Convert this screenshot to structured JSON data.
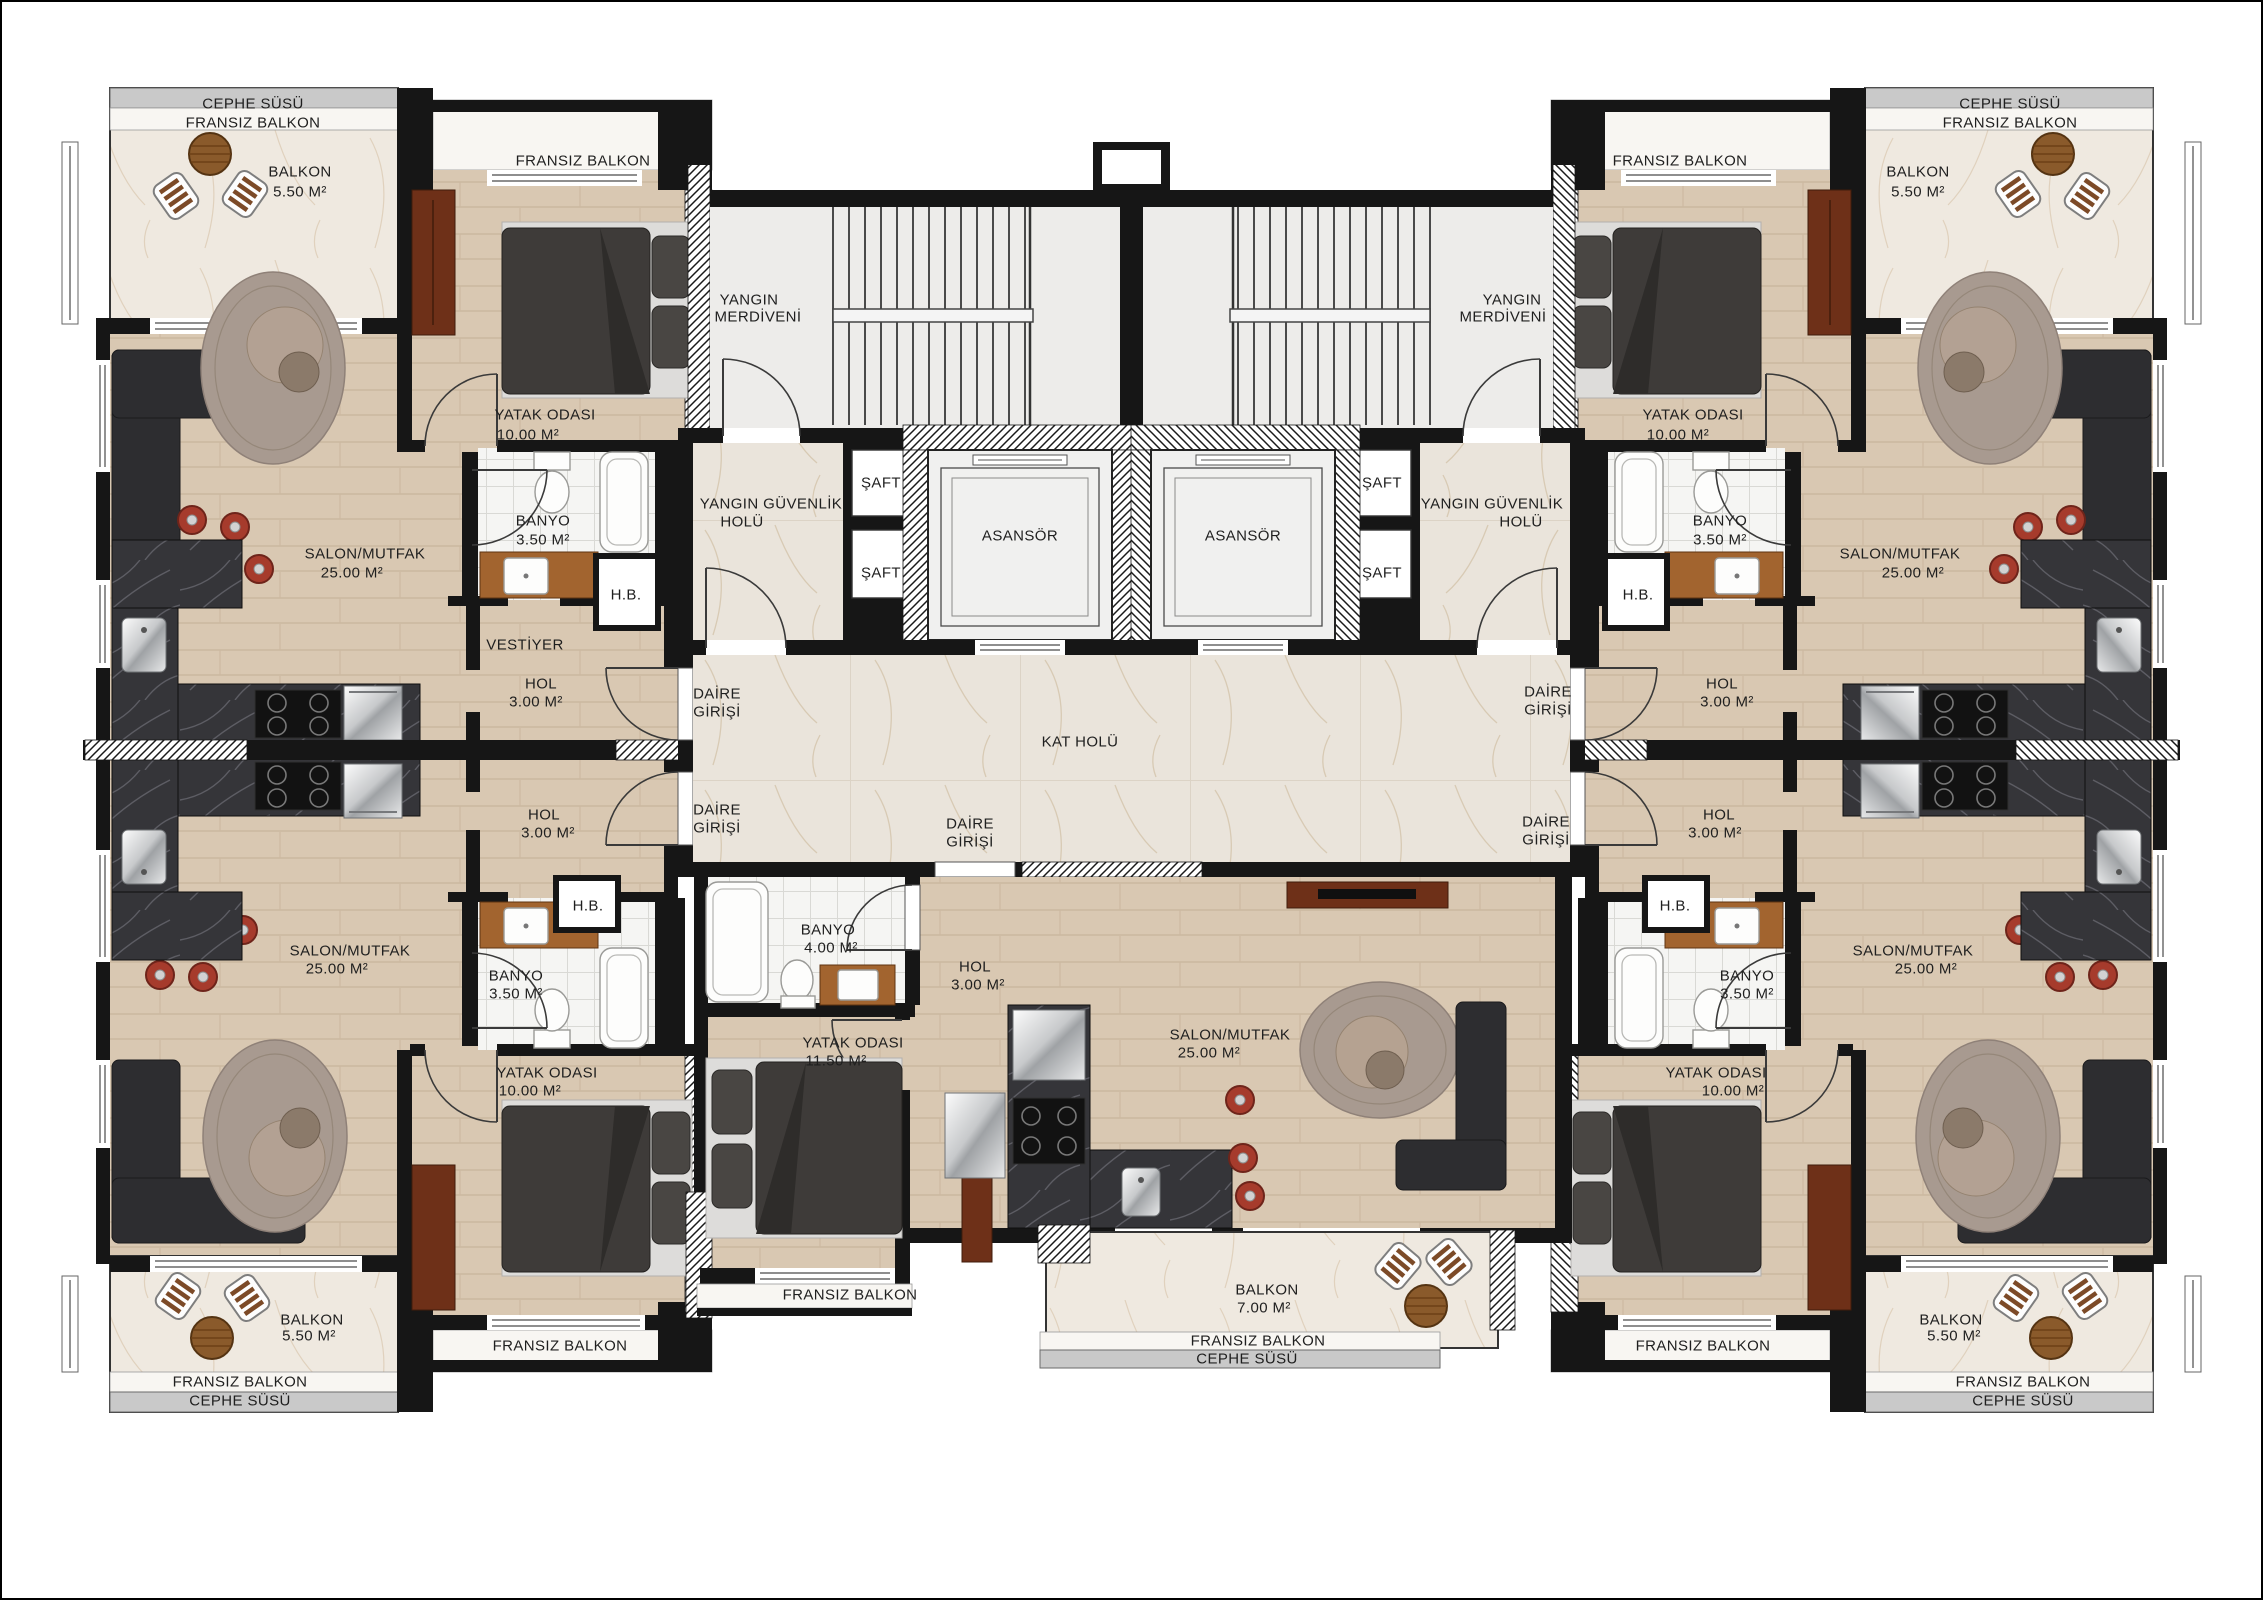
{
  "doc": {
    "type": "architectural-floor-plan",
    "language": "Turkish"
  },
  "colors": {
    "wall": "#161616",
    "wood_floor": "#d9c8b2",
    "corridor_marble": "#eae4db",
    "balcony_marble": "#efe9e0",
    "tile": "#f5f5f3",
    "counter_dark_marble": "#353539",
    "facade_band": "#c9c9c9",
    "sofa": "#2d2d30",
    "bed": "#3e3b39",
    "furniture_wood": "#6e3018",
    "stool_red": "#a63b2c",
    "steel": "#c7c9cb"
  },
  "labels": [
    {
      "id": "cephe-tl",
      "text": "CEPHE SÜSÜ",
      "x": 253,
      "y": 104
    },
    {
      "id": "fransiz-tl",
      "text": "FRANSIZ BALKON",
      "x": 253,
      "y": 123
    },
    {
      "id": "balkon-tl",
      "text": "BALKON",
      "x": 300,
      "y": 172
    },
    {
      "id": "balkon-tl-area",
      "text": "5.50 M²",
      "x": 300,
      "y": 192
    },
    {
      "id": "fransiz-tl-bed",
      "text": "FRANSIZ BALKON",
      "x": 583,
      "y": 161
    },
    {
      "id": "yatak-tl",
      "text": "YATAK ODASI",
      "x": 545,
      "y": 415
    },
    {
      "id": "yatak-tl-area",
      "text": "10.00 M²",
      "x": 528,
      "y": 435
    },
    {
      "id": "banyo-tl",
      "text": "BANYO",
      "x": 543,
      "y": 521
    },
    {
      "id": "banyo-tl-area",
      "text": "3.50 M²",
      "x": 543,
      "y": 540
    },
    {
      "id": "hb-tl",
      "text": "H.B.",
      "x": 626,
      "y": 595
    },
    {
      "id": "vestiyer-tl",
      "text": "VESTİYER",
      "x": 525,
      "y": 645
    },
    {
      "id": "hol-tl",
      "text": "HOL",
      "x": 541,
      "y": 684
    },
    {
      "id": "hol-tl-area",
      "text": "3.00 M²",
      "x": 536,
      "y": 702
    },
    {
      "id": "salon-tl",
      "text": "SALON/MUTFAK",
      "x": 365,
      "y": 554
    },
    {
      "id": "salon-tl-area",
      "text": "25.00 M²",
      "x": 352,
      "y": 573
    },
    {
      "id": "yangin-l1",
      "text": "YANGIN",
      "x": 749,
      "y": 300
    },
    {
      "id": "yangin-l2",
      "text": "MERDİVENİ",
      "x": 758,
      "y": 317
    },
    {
      "id": "yangin-r1",
      "text": "YANGIN",
      "x": 1512,
      "y": 300
    },
    {
      "id": "yangin-r2",
      "text": "MERDİVENİ",
      "x": 1503,
      "y": 317
    },
    {
      "id": "guvenlik-l1",
      "text": "YANGIN GÜVENLİK",
      "x": 771,
      "y": 504
    },
    {
      "id": "guvenlik-l2",
      "text": "HOLÜ",
      "x": 742,
      "y": 522
    },
    {
      "id": "guvenlik-r1",
      "text": "YANGIN GÜVENLİK",
      "x": 1492,
      "y": 504
    },
    {
      "id": "guvenlik-r2",
      "text": "HOLÜ",
      "x": 1521,
      "y": 522
    },
    {
      "id": "saft-l1",
      "text": "ŞAFT",
      "x": 881,
      "y": 483
    },
    {
      "id": "saft-l2",
      "text": "ŞAFT",
      "x": 881,
      "y": 573
    },
    {
      "id": "saft-r1",
      "text": "ŞAFT",
      "x": 1382,
      "y": 483
    },
    {
      "id": "saft-r2",
      "text": "ŞAFT",
      "x": 1382,
      "y": 573
    },
    {
      "id": "asansor-l",
      "text": "ASANSÖR",
      "x": 1020,
      "y": 536
    },
    {
      "id": "asansor-r",
      "text": "ASANSÖR",
      "x": 1243,
      "y": 536
    },
    {
      "id": "kat-holu",
      "text": "KAT HOLÜ",
      "x": 1080,
      "y": 742
    },
    {
      "id": "daire-l1a",
      "text": "DAİRE",
      "x": 717,
      "y": 694
    },
    {
      "id": "daire-l1b",
      "text": "GİRİŞİ",
      "x": 717,
      "y": 712
    },
    {
      "id": "daire-l2a",
      "text": "DAİRE",
      "x": 717,
      "y": 810
    },
    {
      "id": "daire-l2b",
      "text": "GİRİŞİ",
      "x": 717,
      "y": 828
    },
    {
      "id": "daire-ca",
      "text": "DAİRE",
      "x": 970,
      "y": 824
    },
    {
      "id": "daire-cb",
      "text": "GİRİŞİ",
      "x": 970,
      "y": 842
    },
    {
      "id": "daire-r1a",
      "text": "DAİRE",
      "x": 1548,
      "y": 692
    },
    {
      "id": "daire-r1b",
      "text": "GİRİŞİ",
      "x": 1548,
      "y": 710
    },
    {
      "id": "daire-r2a",
      "text": "DAİRE",
      "x": 1546,
      "y": 822
    },
    {
      "id": "daire-r2b",
      "text": "GİRİŞİ",
      "x": 1546,
      "y": 840
    },
    {
      "id": "yatak-tr",
      "text": "YATAK ODASI",
      "x": 1693,
      "y": 415
    },
    {
      "id": "yatak-tr-area",
      "text": "10.00 M²",
      "x": 1678,
      "y": 435
    },
    {
      "id": "fransiz-tr-bed",
      "text": "FRANSIZ BALKON",
      "x": 1680,
      "y": 161
    },
    {
      "id": "cephe-tr",
      "text": "CEPHE SÜSÜ",
      "x": 2010,
      "y": 104
    },
    {
      "id": "fransiz-tr",
      "text": "FRANSIZ BALKON",
      "x": 2010,
      "y": 123
    },
    {
      "id": "balkon-tr",
      "text": "BALKON",
      "x": 1918,
      "y": 172
    },
    {
      "id": "balkon-tr-area",
      "text": "5.50 M²",
      "x": 1918,
      "y": 192
    },
    {
      "id": "banyo-tr",
      "text": "BANYO",
      "x": 1720,
      "y": 521
    },
    {
      "id": "banyo-tr-area",
      "text": "3.50 M²",
      "x": 1720,
      "y": 540
    },
    {
      "id": "hb-tr",
      "text": "H.B.",
      "x": 1638,
      "y": 595
    },
    {
      "id": "hol-tr",
      "text": "HOL",
      "x": 1722,
      "y": 684
    },
    {
      "id": "hol-tr-area",
      "text": "3.00 M²",
      "x": 1727,
      "y": 702
    },
    {
      "id": "salon-tr",
      "text": "SALON/MUTFAK",
      "x": 1900,
      "y": 554
    },
    {
      "id": "salon-tr-area",
      "text": "25.00 M²",
      "x": 1913,
      "y": 573
    },
    {
      "id": "salon-bl",
      "text": "SALON/MUTFAK",
      "x": 350,
      "y": 951
    },
    {
      "id": "salon-bl-area",
      "text": "25.00 M²",
      "x": 337,
      "y": 969
    },
    {
      "id": "hb-bl",
      "text": "H.B.",
      "x": 588,
      "y": 906
    },
    {
      "id": "banyo-bl",
      "text": "BANYO",
      "x": 516,
      "y": 976
    },
    {
      "id": "banyo-bl-area",
      "text": "3.50 M²",
      "x": 516,
      "y": 994
    },
    {
      "id": "hol-bl",
      "text": "HOL",
      "x": 544,
      "y": 815
    },
    {
      "id": "hol-bl-area",
      "text": "3.00 M²",
      "x": 548,
      "y": 833
    },
    {
      "id": "yatak-bl",
      "text": "YATAK ODASI",
      "x": 547,
      "y": 1073
    },
    {
      "id": "yatak-bl-area",
      "text": "10.00 M²",
      "x": 530,
      "y": 1091
    },
    {
      "id": "balkon-bl",
      "text": "BALKON",
      "x": 312,
      "y": 1320
    },
    {
      "id": "balkon-bl-area",
      "text": "5.50 M²",
      "x": 309,
      "y": 1336
    },
    {
      "id": "fransiz-bl-bed",
      "text": "FRANSIZ BALKON",
      "x": 560,
      "y": 1346
    },
    {
      "id": "fransiz-bl",
      "text": "FRANSIZ BALKON",
      "x": 240,
      "y": 1382
    },
    {
      "id": "cephe-bl",
      "text": "CEPHE SÜSÜ",
      "x": 240,
      "y": 1401
    },
    {
      "id": "banyo-c",
      "text": "BANYO",
      "x": 828,
      "y": 930
    },
    {
      "id": "banyo-c-area",
      "text": "4.00 M²",
      "x": 831,
      "y": 948
    },
    {
      "id": "hol-c",
      "text": "HOL",
      "x": 975,
      "y": 967
    },
    {
      "id": "hol-c-area",
      "text": "3.00 M²",
      "x": 978,
      "y": 985
    },
    {
      "id": "yatak-c",
      "text": "YATAK ODASI",
      "x": 853,
      "y": 1043
    },
    {
      "id": "yatak-c-area",
      "text": "11.50 M²",
      "x": 836,
      "y": 1061
    },
    {
      "id": "salon-c",
      "text": "SALON/MUTFAK",
      "x": 1230,
      "y": 1035
    },
    {
      "id": "salon-c-area",
      "text": "25.00 M²",
      "x": 1209,
      "y": 1053
    },
    {
      "id": "fransiz-c-bed",
      "text": "FRANSIZ BALKON",
      "x": 850,
      "y": 1295
    },
    {
      "id": "balkon-c",
      "text": "BALKON",
      "x": 1267,
      "y": 1290
    },
    {
      "id": "balkon-c-area",
      "text": "7.00 M²",
      "x": 1264,
      "y": 1308
    },
    {
      "id": "fransiz-c",
      "text": "FRANSIZ BALKON",
      "x": 1258,
      "y": 1341
    },
    {
      "id": "cephe-c",
      "text": "CEPHE SÜSÜ",
      "x": 1247,
      "y": 1359
    },
    {
      "id": "salon-br",
      "text": "SALON/MUTFAK",
      "x": 1913,
      "y": 951
    },
    {
      "id": "salon-br-area",
      "text": "25.00 M²",
      "x": 1926,
      "y": 969
    },
    {
      "id": "hb-br",
      "text": "H.B.",
      "x": 1675,
      "y": 906
    },
    {
      "id": "banyo-br",
      "text": "BANYO",
      "x": 1747,
      "y": 976
    },
    {
      "id": "banyo-br-area",
      "text": "3.50 M²",
      "x": 1747,
      "y": 994
    },
    {
      "id": "hol-br",
      "text": "HOL",
      "x": 1719,
      "y": 815
    },
    {
      "id": "hol-br-area",
      "text": "3.00 M²",
      "x": 1715,
      "y": 833
    },
    {
      "id": "yatak-br",
      "text": "YATAK ODASI",
      "x": 1716,
      "y": 1073
    },
    {
      "id": "yatak-br-area",
      "text": "10.00 M²",
      "x": 1733,
      "y": 1091
    },
    {
      "id": "balkon-br",
      "text": "BALKON",
      "x": 1951,
      "y": 1320
    },
    {
      "id": "balkon-br-area",
      "text": "5.50 M²",
      "x": 1954,
      "y": 1336
    },
    {
      "id": "fransiz-br-bed",
      "text": "FRANSIZ BALKON",
      "x": 1703,
      "y": 1346
    },
    {
      "id": "fransiz-br",
      "text": "FRANSIZ BALKON",
      "x": 2023,
      "y": 1382
    },
    {
      "id": "cephe-br",
      "text": "CEPHE SÜSÜ",
      "x": 2023,
      "y": 1401
    }
  ]
}
